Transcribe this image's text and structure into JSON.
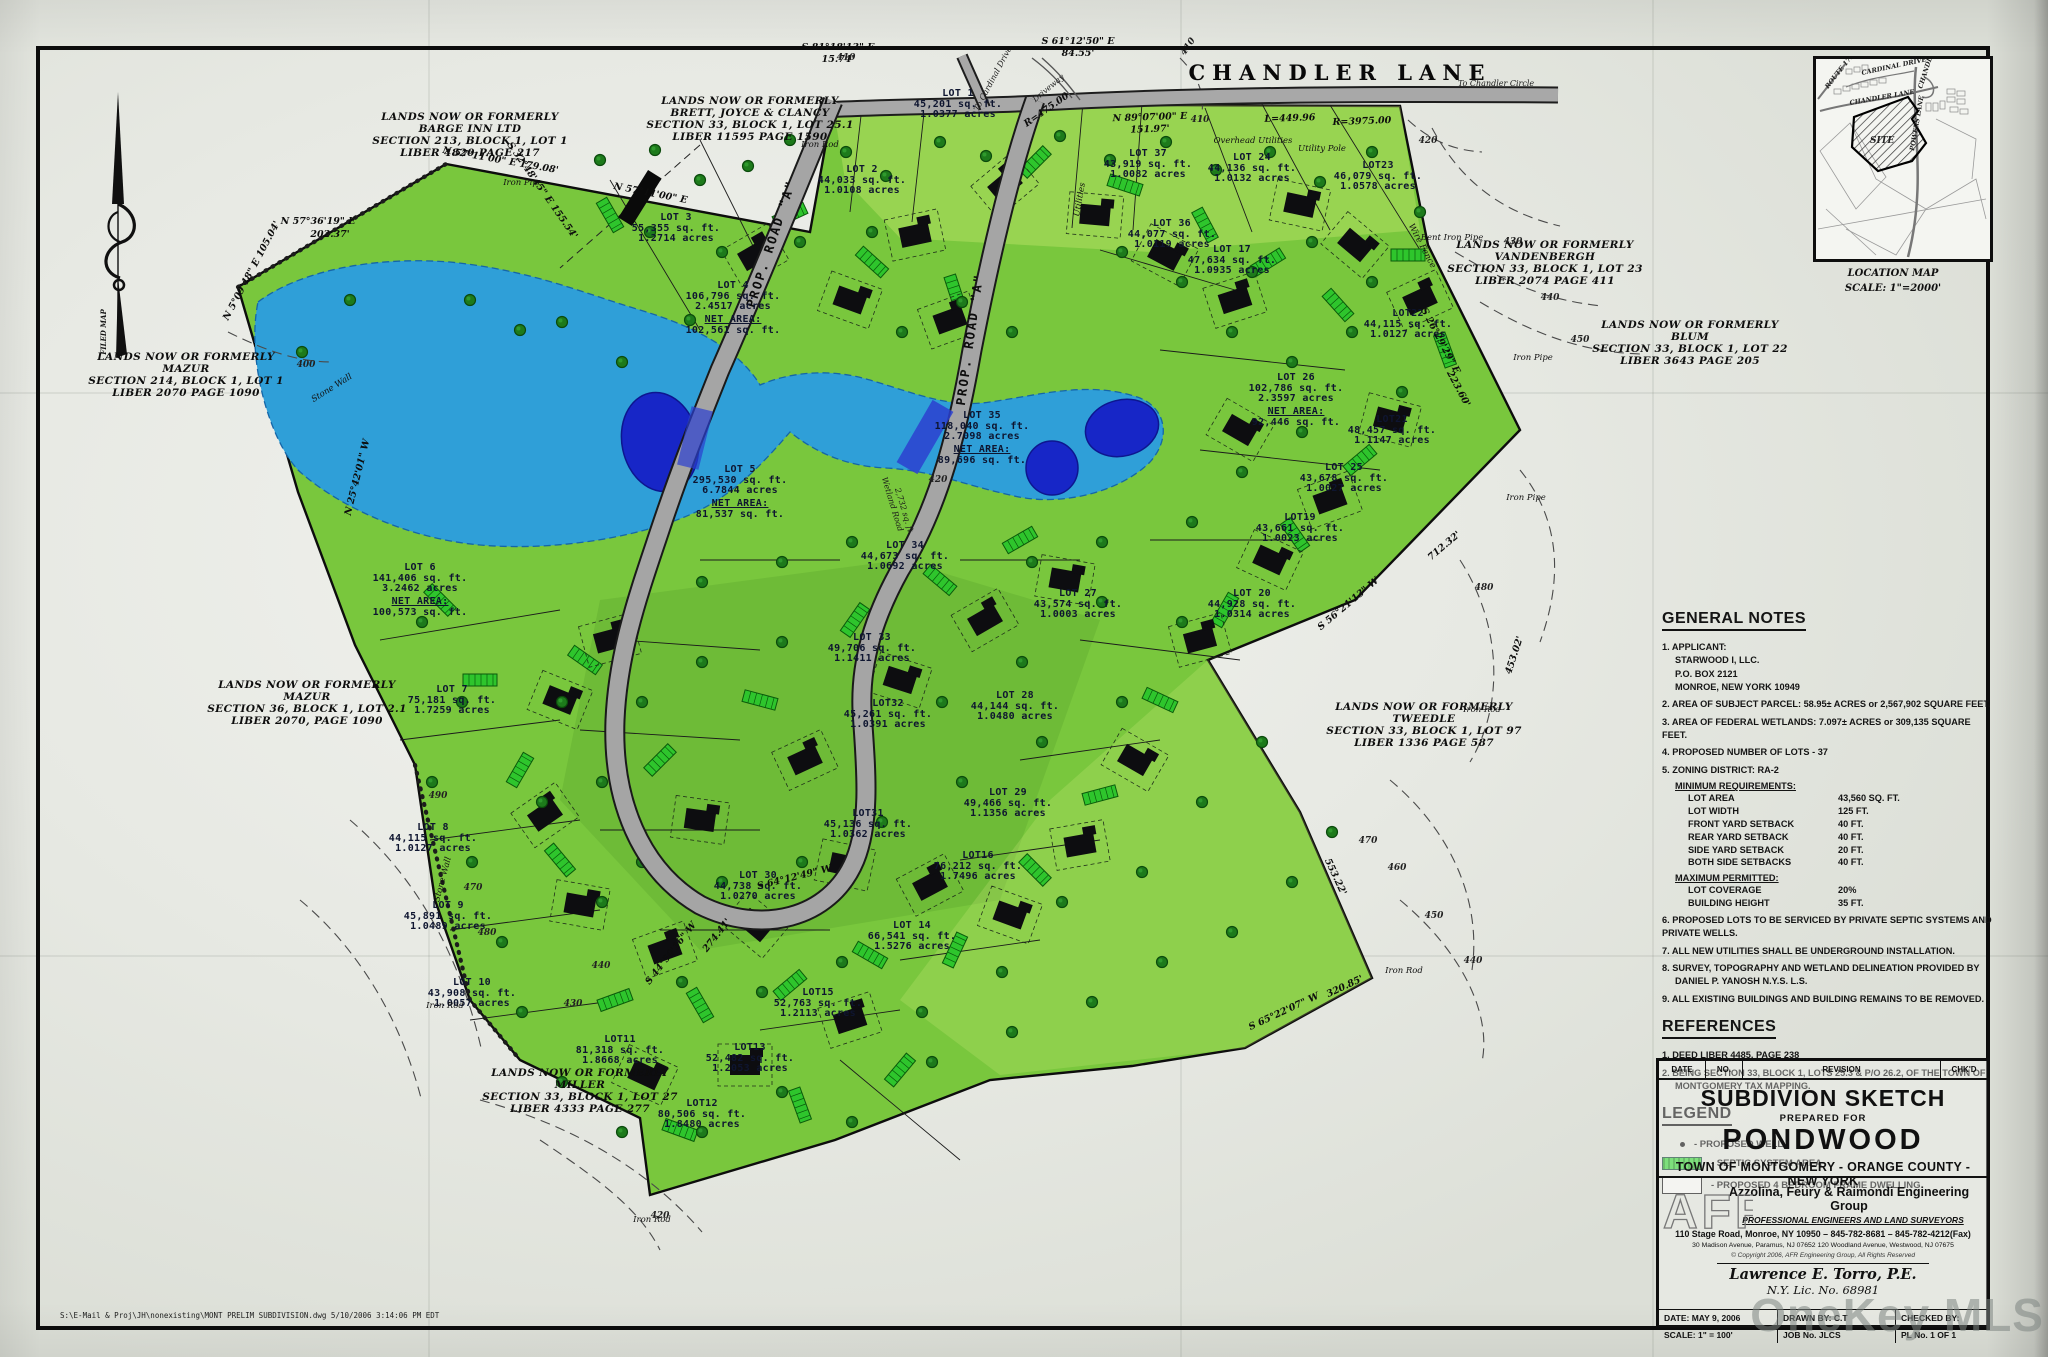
{
  "paper": {
    "watermark": "OneKey MLS",
    "footer_path": "S:\\E-Mail & Proj\\JH\\nonexisting\\MONT PRELIM SUBDIVISION.dwg   5/10/2006   3:14:06 PM EDT"
  },
  "roads": {
    "chandler": "CHANDLER  LANE",
    "prop_a": "PROP.  ROAD  \"A\"",
    "to_cardinal": "To Cardinal Drive",
    "to_chandler_circle": "To Chandler Circle",
    "driveway": "Driveway",
    "wetland_road_1": "Wetland Road",
    "wetland_road_2": "2,732 sq. ft."
  },
  "compass": {
    "label": "FILED MAP"
  },
  "adjoiners": [
    {
      "l1": "LANDS NOW OR FORMERLY",
      "l2": "BARGE INN LTD",
      "l3": "SECTION 213, BLOCK 1, LOT 1",
      "l4": "LIBER 4820 PAGE 217"
    },
    {
      "l1": "LANDS NOW OR FORMERLY",
      "l2": "BRETT, JOYCE & CLANCY",
      "l3": "SECTION 33, BLOCK 1, LOT 25.1",
      "l4": "LIBER 11595 PAGE 1590"
    },
    {
      "l1": "LANDS NOW OR FORMERLY",
      "l2": "MAZUR",
      "l3": "SECTION 214, BLOCK 1, LOT 1",
      "l4": "LIBER 2070 PAGE 1090"
    },
    {
      "l1": "LANDS NOW OR FORMERLY",
      "l2": "MAZUR",
      "l3": "SECTION 36, BLOCK 1, LOT 2.1",
      "l4": "LIBER 2070, PAGE 1090"
    },
    {
      "l1": "LANDS NOW OR FORMERLY",
      "l2": "MILLER",
      "l3": "SECTION 33, BLOCK 1, LOT 27",
      "l4": "LIBER 4333 PAGE 277"
    },
    {
      "l1": "LANDS NOW OR FORMERLY",
      "l2": "TWEEDLE",
      "l3": "SECTION 33, BLOCK 1, LOT 97",
      "l4": "LIBER 1336 PAGE 587"
    },
    {
      "l1": "LANDS NOW OR FORMERLY",
      "l2": "VANDENBERGH",
      "l3": "SECTION 33, BLOCK 1, LOT 23",
      "l4": "LIBER 2074 PAGE 411"
    },
    {
      "l1": "LANDS NOW OR FORMERLY",
      "l2": "BLUM",
      "l3": "SECTION 33, BLOCK 1, LOT 22",
      "l4": "LIBER 3643 PAGE 205"
    }
  ],
  "lots": [
    {
      "n": "LOT 1",
      "s": "45,201 sq. ft.",
      "a": "1.0377 acres"
    },
    {
      "n": "LOT 2",
      "s": "44,033 sq. ft.",
      "a": "1.0108 acres"
    },
    {
      "n": "LOT 3",
      "s": "55,355 sq. ft.",
      "a": "1.2714 acres"
    },
    {
      "n": "LOT 4",
      "s": "106,796 sq. ft.",
      "a": "2.4517 acres",
      "nl": "NET AREA:",
      "nv": "102,561 sq. ft."
    },
    {
      "n": "LOT 5",
      "s": "295,530 sq. ft.",
      "a": "6.7844 acres",
      "nl": "NET AREA:",
      "nv": "81,537 sq. ft."
    },
    {
      "n": "LOT 6",
      "s": "141,406 sq. ft.",
      "a": "3.2462 acres",
      "nl": "NET AREA:",
      "nv": "100,573 sq. ft."
    },
    {
      "n": "LOT 7",
      "s": "75,181 sq. ft.",
      "a": "1.7259 acres"
    },
    {
      "n": "LOT 8",
      "s": "44,115 sq. ft.",
      "a": "1.0127 acres"
    },
    {
      "n": "LOT 9",
      "s": "45,891 sq. ft.",
      "a": "1.0489 acres"
    },
    {
      "n": "LOT 10",
      "s": "43,908 sq. ft.",
      "a": "1.0057 acres"
    },
    {
      "n": "LOT11",
      "s": "81,318 sq. ft.",
      "a": "1.8668 acres"
    },
    {
      "n": "LOT12",
      "s": "80,506 sq. ft.",
      "a": "1.8480 acres"
    },
    {
      "n": "LOT13",
      "s": "52,482 sq. ft.",
      "a": "1.2053 acres"
    },
    {
      "n": "LOT 14",
      "s": "66,541 sq. ft.",
      "a": "1.5276 acres"
    },
    {
      "n": "LOT15",
      "s": "52,763 sq. ft.",
      "a": "1.2113 acres"
    },
    {
      "n": "LOT16",
      "s": "76,212 sq. ft.",
      "a": "1.7496 acres"
    },
    {
      "n": "LOT 29",
      "s": "49,466 sq. ft.",
      "a": "1.1356 acres"
    },
    {
      "n": "LOT 30",
      "s": "44,738 sq. ft.",
      "a": "1.0270 acres"
    },
    {
      "n": "LOT31",
      "s": "45,136 sq. ft.",
      "a": "1.0362 acres"
    },
    {
      "n": "LOT32",
      "s": "45,261 sq. ft.",
      "a": "1.0391 acres"
    },
    {
      "n": "LOT 33",
      "s": "49,706 sq. ft.",
      "a": "1.1411 acres"
    },
    {
      "n": "LOT 34",
      "s": "44,673 sq. ft.",
      "a": "1.0692 acres"
    },
    {
      "n": "LOT 35",
      "s": "118,040 sq. ft.",
      "a": "2.7098 acres",
      "nl": "NET AREA:",
      "nv": "89,696 sq. ft."
    },
    {
      "n": "LOT 27",
      "s": "43,574 sq. ft.",
      "a": "1.0003 acres"
    },
    {
      "n": "LOT 28",
      "s": "44,144 sq. ft.",
      "a": "1.0480 acres"
    },
    {
      "n": "LOT 36",
      "s": "44,077 sq. ft.",
      "a": "1.0119 acres"
    },
    {
      "n": "LOT 17",
      "s": "47,634 sq. ft.",
      "a": "1.0935 acres"
    },
    {
      "n": "LOT 37",
      "s": "43,919 sq. ft.",
      "a": "1.0082 acres"
    },
    {
      "n": "LOT 24",
      "s": "44,136 sq. ft.",
      "a": "1.0132 acres"
    },
    {
      "n": "LOT23",
      "s": "46,079 sq. ft.",
      "a": "1.0578 acres"
    },
    {
      "n": "LOT22",
      "s": "44,115 sq. ft.",
      "a": "1.0127 acres"
    },
    {
      "n": "LOT21",
      "s": "48,457 sq. ft.",
      "a": "1.1147 acres"
    },
    {
      "n": "LOT 26",
      "s": "102,786 sq. ft.",
      "a": "2.3597 acres",
      "nl": "NET AREA:",
      "nv": "92,446 sq. ft."
    },
    {
      "n": "LOT 25",
      "s": "43,678 sq. ft.",
      "a": "1.0027 acres"
    },
    {
      "n": "LOT19",
      "s": "43,661 sq. ft.",
      "a": "1.0023 acres"
    },
    {
      "n": "LOT 20",
      "s": "44,928 sq. ft.",
      "a": "1.0314 acres"
    }
  ],
  "ann": [
    "N 57°36'19\" E",
    "202.37'",
    "N 5°09'48\" E  105.04'",
    "N 57°11'00\" E  179.08'",
    "S 32°48'45\" E  155.54'",
    "N 57°11'00\" E",
    "S 81°18'13\" E",
    "15.74'",
    "S 61°12'50\" E",
    "84.55'",
    "N 89°07'00\" E",
    "151.97'",
    "L=449.96",
    "R=3975.00",
    "R=475.00",
    "S 26°29'29\" E",
    "223.60'",
    "712.32'",
    "S 56°21'13\" W",
    "553.22'",
    "S 65°22'07\" W",
    "320.85'",
    "S 64°12'49\" W",
    "S 44°50'16\" W",
    "274.41'",
    "N 25°42'01\" W",
    "Iron Rod",
    "Iron Pipe",
    "Bent Iron Pipe",
    "Overhead Utilities",
    "Utility Pole",
    "Utilities",
    "Stone Wall",
    "Wire Fence",
    "453.02'"
  ],
  "topo": [
    "400",
    "410",
    "420",
    "430",
    "440",
    "450",
    "460",
    "470",
    "480",
    "490"
  ],
  "location_map": {
    "title": "LOCATION MAP",
    "scale": "SCALE:   1\"=2000'",
    "site": "SITE",
    "r1": "ROUTE 17K",
    "r2": "CARDINAL DRIVE",
    "r3": "CHANDLER LANE",
    "r4": "CHANDLER CIRCLE",
    "r5": "POWERS LANE"
  },
  "notes": {
    "header": "GENERAL NOTES",
    "items": [
      "1. APPLICANT:",
      "STARWOOD I, LLC.",
      "P.O. BOX 2121",
      "MONROE, NEW YORK 10949",
      "2. AREA OF SUBJECT PARCEL:  58.95± ACRES or 2,567,902 SQUARE FEET.",
      "3. AREA OF FEDERAL WETLANDS:  7.097± ACRES or 309,135 SQUARE FEET.",
      "4. PROPOSED NUMBER OF LOTS - 37",
      "5. ZONING DISTRICT: RA-2"
    ],
    "min_header": "MINIMUM REQUIREMENTS:",
    "min_rows": [
      [
        "LOT AREA",
        "43,560 SQ. FT."
      ],
      [
        "LOT WIDTH",
        "125 FT."
      ],
      [
        "FRONT YARD SETBACK",
        "40 FT."
      ],
      [
        "REAR YARD SETBACK",
        "40 FT."
      ],
      [
        "SIDE YARD SETBACK",
        "20 FT."
      ],
      [
        "BOTH SIDE SETBACKS",
        "40 FT."
      ]
    ],
    "max_header": "MAXIMUM PERMITTED:",
    "max_rows": [
      [
        "LOT COVERAGE",
        "20%"
      ],
      [
        "BUILDING HEIGHT",
        "35 FT."
      ]
    ],
    "items2": [
      "6. PROPOSED LOTS TO BE SERVICED BY PRIVATE SEPTIC SYSTEMS AND PRIVATE WELLS.",
      "7. ALL NEW UTILITIES SHALL BE UNDERGROUND INSTALLATION.",
      "8. SURVEY, TOPOGRAPHY AND WETLAND DELINEATION PROVIDED BY",
      "DANIEL P. YANOSH N.Y.S. L.S.",
      "9. ALL EXISTING BUILDINGS AND BUILDING REMAINS TO BE REMOVED."
    ]
  },
  "references": {
    "header": "REFERENCES",
    "items": [
      "1. DEED LIBER 4485, PAGE 238",
      "2. BEING SECTION 33, BLOCK 1, LOTS 25.3 & P/O 26.2, OF THE TOWN OF",
      "MONTGOMERY TAX MAPPING."
    ]
  },
  "legend": {
    "header": "LEGEND",
    "well": "- PROPOSED WELL",
    "septic": "- SEPTIC SYSTEM AREA",
    "dwelling": "- PROPOSED 4 BEDROOM FRAME DWELLING"
  },
  "titleblock": {
    "rev_date": "DATE",
    "rev_no": "NO.",
    "rev_revision": "REVISION",
    "rev_chkd": "CHK'D",
    "title": "SUBDIVION SKETCH",
    "prepared": "PREPARED FOR",
    "project": "PONDWOOD",
    "location": "TOWN OF MONTGOMERY - ORANGE COUNTY - NEW YORK",
    "firm_logo": "AFR",
    "firm_name": "Azzolina, Feury & Raimondi Engineering Group",
    "firm_sub": "PROFESSIONAL ENGINEERS AND LAND SURVEYORS",
    "firm_addr1": "110 Stage Road, Monroe, NY 10950  –  845-782-8681  –  845-782-4212(Fax)",
    "firm_addr2": "30 Madison Avenue, Paramus, NJ 07652      120 Woodland Avenue, Westwood, NJ 07675",
    "copyright": "© Copyright 2006, AFR Engineering Group, All Rights Reserved",
    "engineer": "Lawrence E. Torro, P.E.",
    "license": "N.Y. Lic. No. 68981",
    "date_label": "DATE:  MAY 9, 2006",
    "drawn_label": "DRAWN BY:  C.T",
    "checked_label": "CHECKED BY:",
    "scale_label": "SCALE: 1\" = 100'",
    "job_label": "JOB No.  JLCS",
    "plate_label": "PL No.  1 OF 1"
  }
}
